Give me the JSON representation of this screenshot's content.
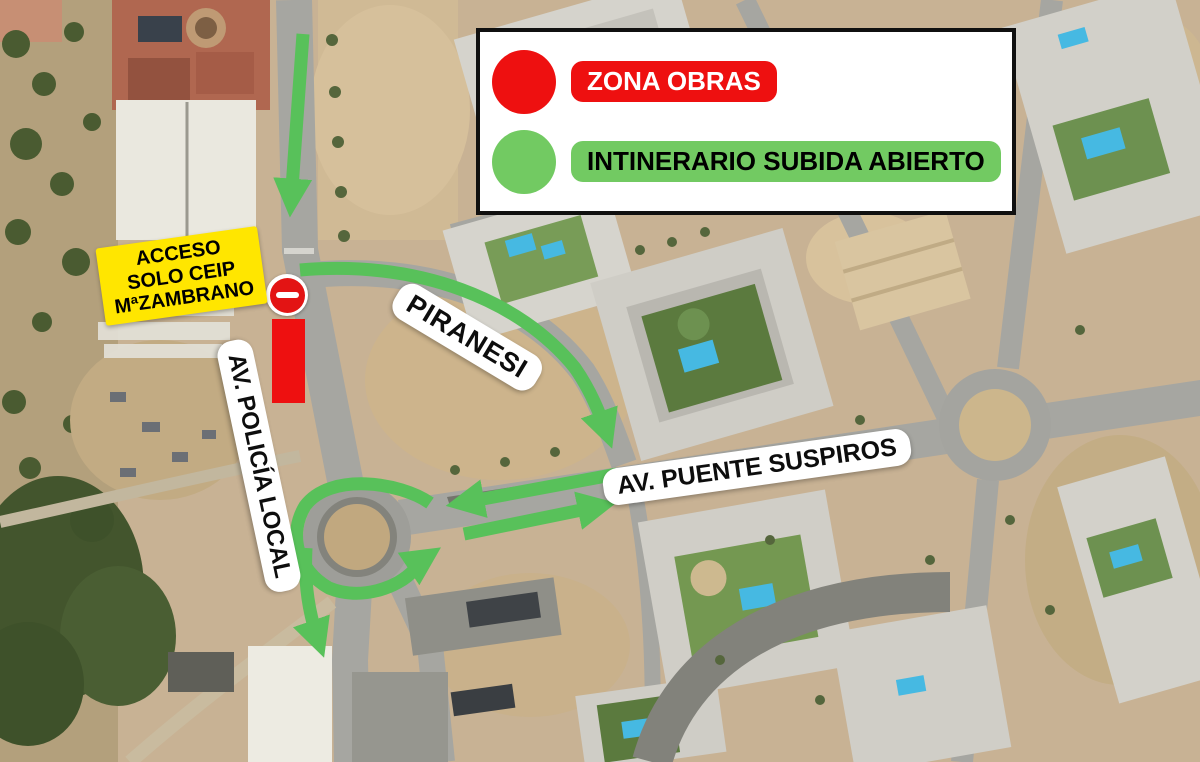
{
  "legend": {
    "items": [
      {
        "id": "zona-obras",
        "label": "ZONA OBRAS",
        "color": "#ee1010",
        "text_color": "#ffffff"
      },
      {
        "id": "itinerario-subida",
        "label": "INTINERARIO SUBIDA ABIERTO",
        "color": "#72ca62",
        "text_color": "#000000"
      }
    ]
  },
  "labels": {
    "access": "ACCESO\nSOLO CEIP\nMªZAMBRANO",
    "piranesi": "PIRANESI",
    "policia_local": "AV. POLICÍA LOCAL",
    "puente_suspiros": "AV. PUENTE SUSPIROS"
  },
  "markers": {
    "no_entry_sign": "no-entry-sign",
    "works_zone_color": "#ee1010",
    "access_label_bg": "#ffe600",
    "route_color": "#58c15a",
    "label_bg": "#ffffff"
  }
}
